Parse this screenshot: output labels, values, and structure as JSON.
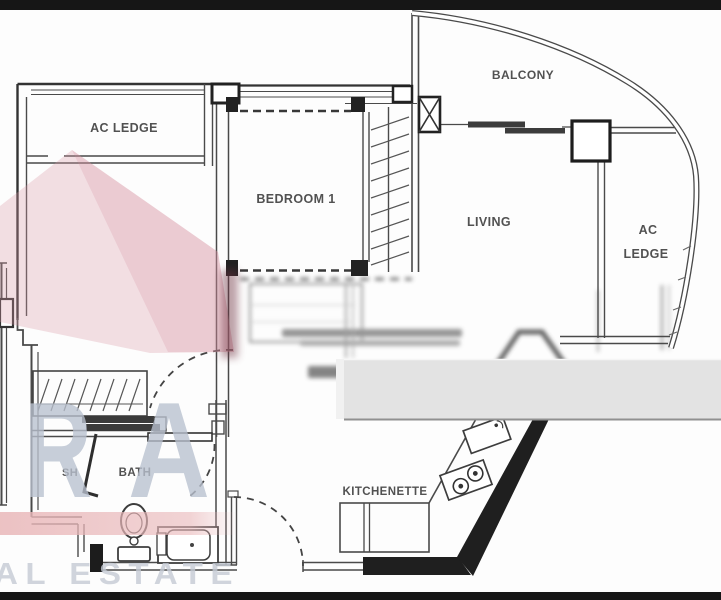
{
  "floorplan": {
    "rooms": {
      "ac_ledge_left": "AC LEDGE",
      "bedroom1": "BEDROOM 1",
      "balcony": "BALCONY",
      "living": "LIVING",
      "ac_ledge_right_line1": "AC",
      "ac_ledge_right_line2": "LEDGE",
      "shower": "SH",
      "bath": "BATH",
      "kitchenette": "KITCHENETTE"
    }
  },
  "watermark": {
    "letter_r": "R",
    "letter_a": "A",
    "banner_text": "AL ESTATE",
    "accent_pink": "#dc97a4",
    "letter_color": "#b9c1cf",
    "band_color": "#e9b7b9"
  },
  "colors": {
    "wall_line": "#4a4a4a",
    "letterbox": "#161616",
    "censor_band": "#e3e3e3",
    "paper": "#ffffff"
  }
}
